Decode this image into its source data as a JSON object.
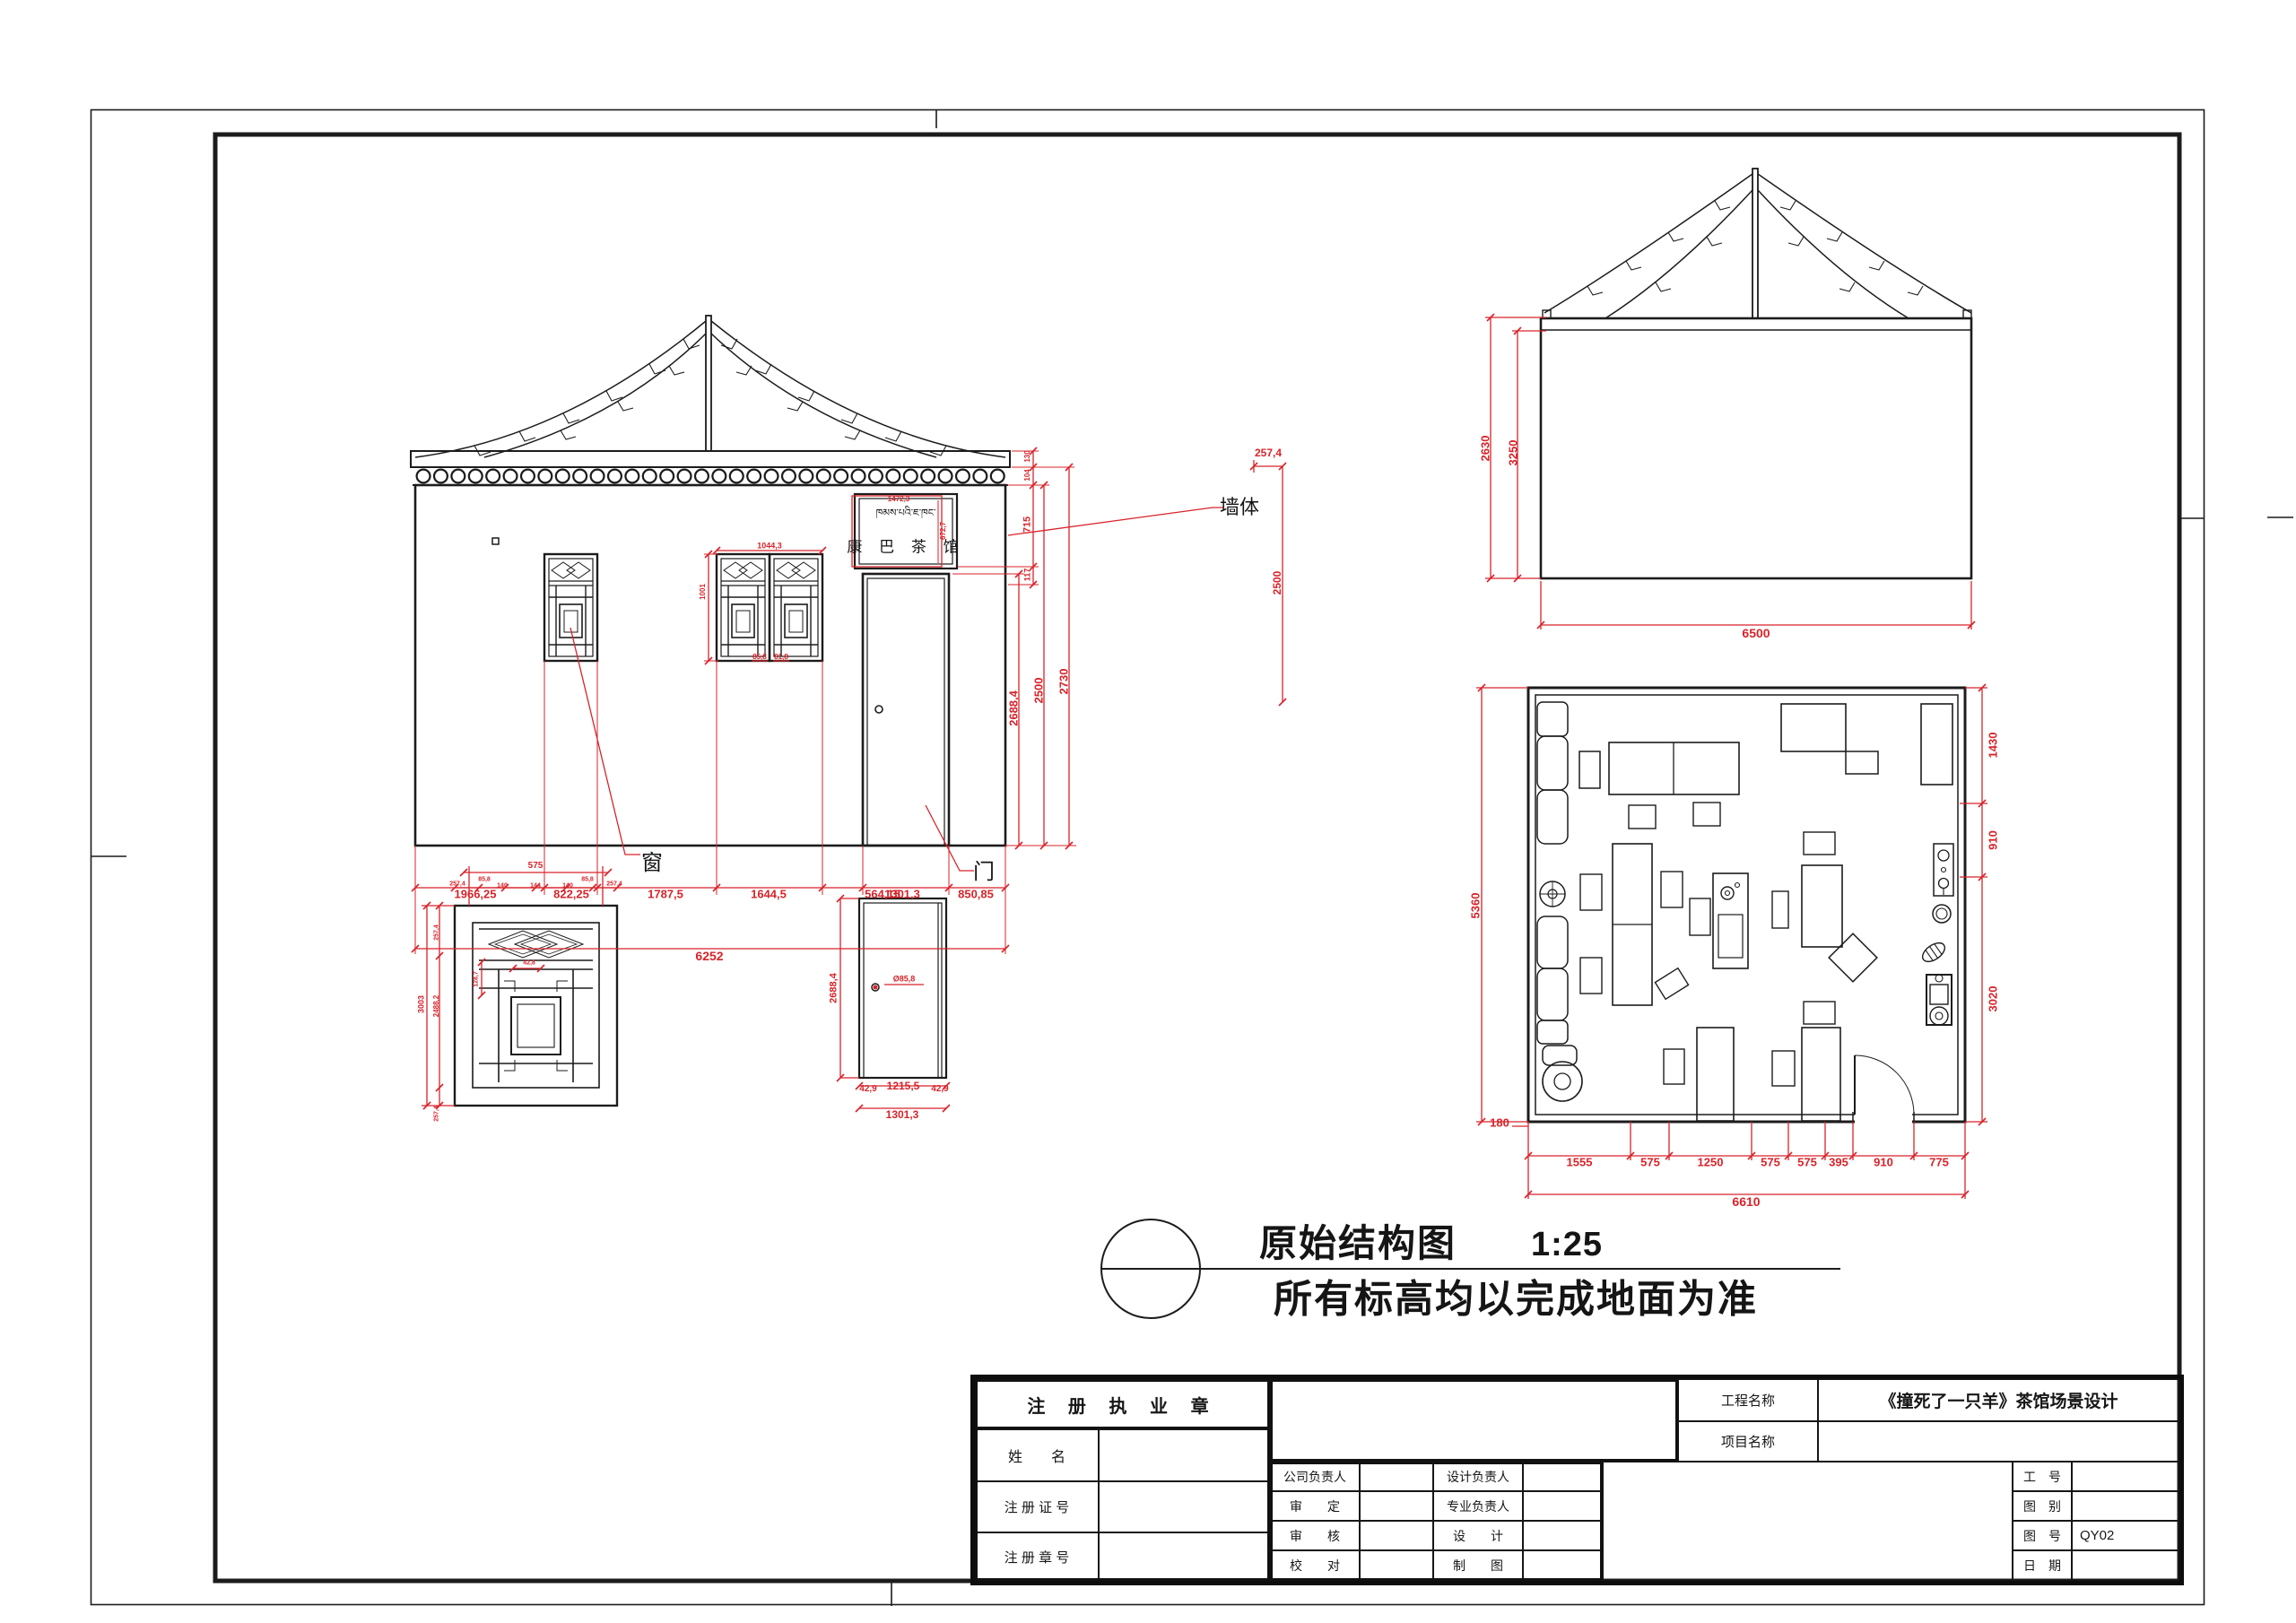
{
  "colors": {
    "line": "#1c1c1c",
    "dim": "#d8232a"
  },
  "front": {
    "sign_tibetan": "ཁམས་པའི་ཇ་ཁང་",
    "sign_cn": "康 巴 茶 馆",
    "sign_w": "1472,3",
    "sign_h": "672,7",
    "bottom": [
      "1966,25",
      "822,25",
      "1787,5",
      "1644,5",
      "564,15",
      "1301,3",
      "850,85"
    ],
    "total": "6252",
    "right": [
      "2688,4",
      "2500",
      "2730"
    ],
    "stack": [
      "130",
      "104",
      "715",
      "117"
    ],
    "win": {
      "w": "1044,3",
      "a": "85,8",
      "b": "81,8",
      "h": "1001"
    },
    "wall_label": "墙体",
    "win_label": "窗",
    "door_label": "门",
    "det_w": "257,4",
    "det_h": "2500"
  },
  "side": {
    "h1": "2630",
    "h2": "3250",
    "w": "6500"
  },
  "plan": {
    "left_h": "5360",
    "offset": "180",
    "right": [
      "1430",
      "910",
      "3020"
    ],
    "bottom": [
      "1555",
      "575",
      "1250",
      "575",
      "575",
      "395",
      "910",
      "775"
    ],
    "total": "6610"
  },
  "window_detail": {
    "top_total": "575",
    "top": [
      "257,4",
      "85,8",
      "140",
      "144",
      "140",
      "85,8",
      "257,4"
    ],
    "left_total": "3003",
    "left": [
      "257,4",
      "2488,2",
      "257,4"
    ],
    "inner_w": "42,8",
    "inner_h": "128,7"
  },
  "door_detail": {
    "h": "2688,4",
    "knob": "Ø85,8",
    "bottom": [
      "42,9",
      "1215,5",
      "42,9"
    ],
    "total": "1301,3"
  },
  "note": {
    "title": "原始结构图",
    "scale": "1:25",
    "subtitle": "所有标高均以完成地面为准"
  },
  "titleblock": {
    "seal": "注 册 执 业 章",
    "name": "姓　　名",
    "cert": "注 册 证 号",
    "sealno": "注 册 章 号",
    "grid": [
      "公司负责人",
      "设计负责人",
      "审　　定",
      "专业负责人",
      "审　　核",
      "设　　计",
      "校　　对",
      "制　　图"
    ],
    "project_label": "工程名称",
    "project_value": "《撞死了一只羊》茶馆场景设计",
    "item_label": "项目名称",
    "job": "工　号",
    "cat": "图　别",
    "no": "图　号",
    "no_value": "QY02",
    "date": "日　期"
  }
}
